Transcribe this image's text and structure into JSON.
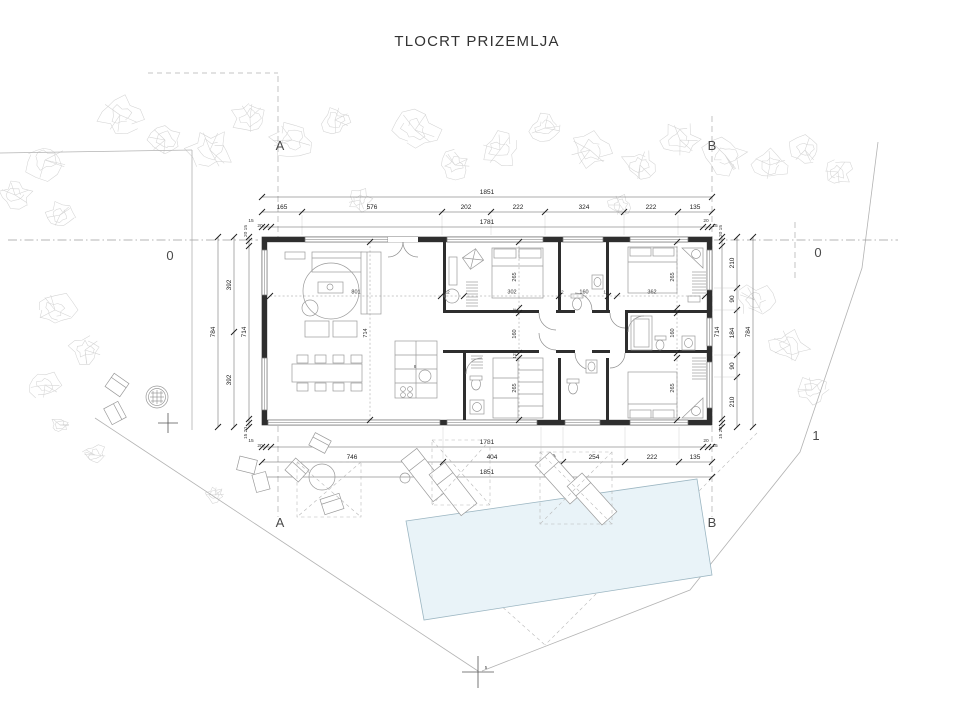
{
  "title": "TLOCRT PRIZEMLJA",
  "axes": {
    "top": [
      "A",
      "B"
    ],
    "bottom": [
      "A",
      "B"
    ],
    "side": [
      "0",
      "0",
      "1"
    ]
  },
  "dimensions": {
    "top": {
      "total": "1851",
      "segments": [
        "165",
        "576",
        "202",
        "222",
        "324",
        "222",
        "135"
      ],
      "inner_total": "1781",
      "wall_left": [
        "15",
        "20"
      ],
      "wall_right": [
        "20",
        "15"
      ]
    },
    "bottom": {
      "inner_total": "1781",
      "segments": [
        "746",
        "404",
        "90",
        "254",
        "222",
        "135"
      ],
      "total": "1851",
      "wall_left": [
        "15",
        "20"
      ],
      "wall_right": [
        "20",
        "15"
      ]
    },
    "left": {
      "total": "784",
      "halves": [
        "392",
        "392"
      ],
      "inner_total": "714",
      "wall_top": "20 15",
      "wall_bottom": "15 20"
    },
    "right": {
      "total": "784",
      "segments": [
        "210",
        "90",
        "184",
        "90",
        "210"
      ],
      "inner_total": "714",
      "wall_top": "20 15",
      "wall_bottom": "15 20"
    },
    "interior": {
      "h_chain": [
        "801",
        "12",
        "302",
        "12",
        "160",
        "12",
        "362"
      ],
      "v_living": "714",
      "v_mid": [
        "265",
        "12",
        "160",
        "12",
        "265"
      ],
      "v_right": [
        "265",
        "160",
        "265"
      ]
    }
  },
  "markers": {
    "survey_point": "5",
    "kitchen_hob": "8"
  },
  "colors": {
    "pool_fill": "#e9f3f8",
    "pool_stroke": "#9cb6c2",
    "wall": "#2e2e2e",
    "dimension": "#222222",
    "vegetation": "#d4d4d4"
  }
}
